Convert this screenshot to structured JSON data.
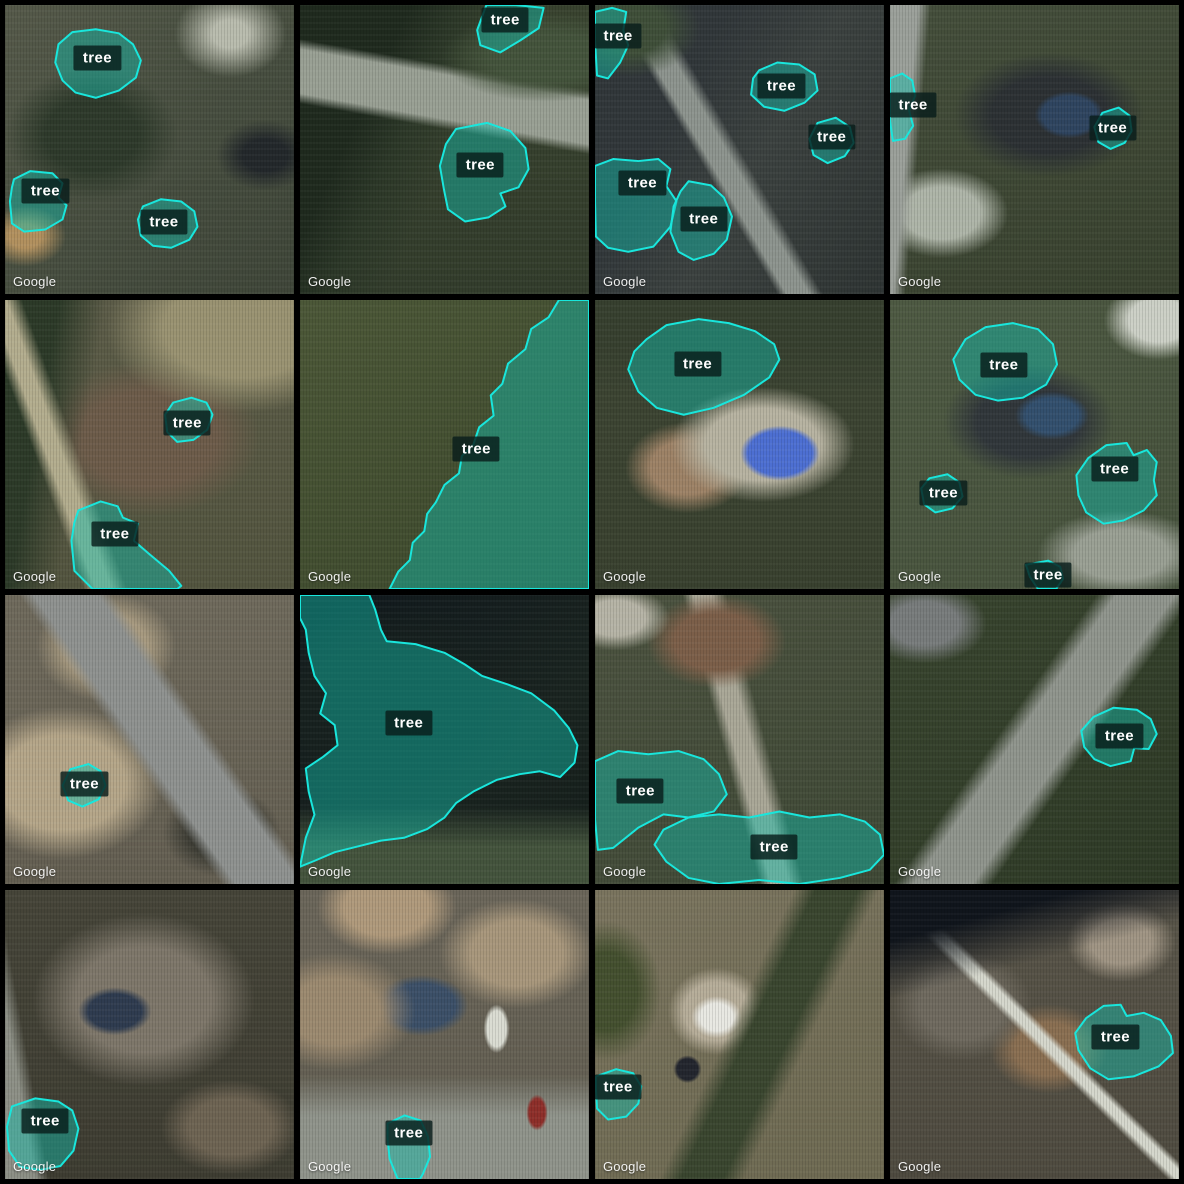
{
  "app": {
    "name": "satellite-tree-annotation-grid"
  },
  "watermark": "Google",
  "annotation_style": {
    "label": "tree",
    "stroke_color": "#19e6dc",
    "fill_color": "rgba(18,190,174,0.45)",
    "label_bg": "rgba(9,29,27,0.82)",
    "label_color": "#ffffff"
  },
  "grid": {
    "rows": 4,
    "cols": 4,
    "gap_px": 6,
    "border_color": "#000000"
  },
  "tiles": [
    {
      "id": "r1c1",
      "annotations": [
        {
          "label": "tree",
          "cx": 32,
          "cy": 18.5,
          "points": "18.5,13.6 23.3,9.4 31.4,8.4 39.4,9.8 44.3,13.6 47,19.2 45.3,25.1 39.4,29.6 31.4,32.1 24.4,30.3 19.9,26.1 17.4,19.9"
        },
        {
          "label": "tree",
          "cx": 14,
          "cy": 64.5,
          "points": "3.1,60.3 8.7,57.5 16.4,58.2 19.9,61.7 18.5,66.6 21.3,69.3 19.9,74.2 13.9,77.7 6.6,78.4 2.4,75.6 1.7,67.9 2.4,63.1"
        },
        {
          "label": "tree",
          "cx": 55,
          "cy": 75,
          "points": "47.7,69.7 54,67.2 61,68 65.5,71.4 66.6,76.7 63.8,81.2 57.5,84 51.2,83.3 47,79.8 46,74.2"
        }
      ]
    },
    {
      "id": "r1c2",
      "annotations": [
        {
          "label": "tree",
          "cx": 71,
          "cy": 5.2,
          "points": "64.5,0 74.6,0 84.3,1 82.6,8 76.3,12.2 69.3,16.4 62.4,13.9 61.3,8.7"
        },
        {
          "label": "tree",
          "cx": 62.4,
          "cy": 55.4,
          "points": "54,42.9 64.8,40.8 72.8,43.6 78,49.5 79.1,56.8 75.6,63.1 69.3,65.2 71.1,69.7 65.2,73.5 57.1,74.9 51.2,70.7 49.8,63.8 48.4,55.7 50.5,48.1"
        }
      ]
    },
    {
      "id": "r1c3",
      "annotations": [
        {
          "label": "tree",
          "cx": 8,
          "cy": 10.8,
          "points": "0,2.4 5.9,1 10.8,2.4 9.8,8.7 11.5,13.9 8.7,19.9 4.5,25.4 0.7,24.4 0,12.2"
        },
        {
          "label": "tree",
          "cx": 64.5,
          "cy": 27.9,
          "points": "56.8,22.6 63.1,19.9 70.7,20.6 76,24 77,29.6 72.5,33.8 65.5,36.6 58.5,35.2 54,31 54.7,25.4"
        },
        {
          "label": "tree",
          "cx": 81.9,
          "cy": 45.6,
          "points": "77,40.8 83.3,39 88.2,42.2 89.5,47.7 86.4,52.3 80.5,54.7 75.6,51.9 74.2,46.3"
        },
        {
          "label": "tree",
          "cx": 16.4,
          "cy": 61.7,
          "points": "0,55.7 6.3,53.3 15,54 21.9,53.3 26.1,56.8 24.7,62.7 28.2,67.9 26.1,76.7 20.2,83.6 11.5,85.4 4.5,84 0.3,80.1 0,67.9"
        },
        {
          "label": "tree",
          "cx": 37.6,
          "cy": 74.2,
          "points": "32.4,61 40.1,62.4 44.6,66.6 47.4,73.2 45.6,81.2 41.1,86.1 34.1,88.2 28.9,85.4 26.1,78.4 27.2,69.7 29.6,64.5"
        }
      ]
    },
    {
      "id": "r1c4",
      "annotations": [
        {
          "label": "tree",
          "cx": 8,
          "cy": 34.5,
          "points": "0,25.4 4.2,23.7 7.7,26.1 8.7,31.4 6.6,36.6 8,41.8 5.2,46.3 1,47 0,40.1"
        },
        {
          "label": "tree",
          "cx": 77,
          "cy": 42.5,
          "points": "73.5,37.3 79.1,35.5 82.9,38.3 83.6,43.6 81.2,47.7 76.3,49.8 72.1,47.4 70.7,42.2"
        }
      ]
    },
    {
      "id": "r2c1",
      "annotations": [
        {
          "label": "tree",
          "cx": 63.1,
          "cy": 42.5,
          "points": "58.2,35.5 64.5,33.8 69.7,35.5 71.8,39.7 70,44.9 65.2,48.4 59.6,49.1 56.1,45.6 55.4,39.7"
        },
        {
          "label": "tree",
          "cx": 38,
          "cy": 80.8,
          "points": "25.4,72.8 33.1,69.7 39,71.4 40.8,75.3 46,77.4 44.6,83.3 49.8,87.8 56.8,93.7 61,98.9 59.6,100 30.3,100 24,93.7 23,83.3 24,77"
        }
      ]
    },
    {
      "id": "r2c2",
      "annotations": [
        {
          "label": "tree",
          "cx": 61,
          "cy": 51.7,
          "points": "89.6,0 100,0 100,100 31,100 34,94 38,90 39,84 43,80 44,74 47,70 50,64 55,60 56,54 60,50 62,44 67,40 66,33 70,29 72,22 78,17 80,10 86,6"
        }
      ]
    },
    {
      "id": "r2c3",
      "annotations": [
        {
          "label": "tree",
          "cx": 35.5,
          "cy": 22,
          "points": "17.8,13.6 24.7,8.7 35.9,6.6 46.3,8 55.4,10.8 62,15.3 63.8,20.6 60.3,26.8 51.6,32.8 41.1,37.3 30.7,39.7 21.3,37.3 15,31.7 11.5,24 13.6,17.8"
        }
      ]
    },
    {
      "id": "r2c4",
      "annotations": [
        {
          "label": "tree",
          "cx": 39.4,
          "cy": 22.5,
          "points": "26.1,13.6 33.1,9.4 42.5,8 51.2,10.1 56.4,15.3 57.8,22.3 54,29.3 46,33.8 37.3,34.8 29.6,32.8 24,27.5 21.9,20.6"
        },
        {
          "label": "tree",
          "cx": 77.7,
          "cy": 58.5,
          "points": "68.6,54.7 74.9,50.2 81.9,49.5 84.3,53.7 88.9,51.9 92.3,56.1 91.3,62.4 92.3,67.6 87.8,72.8 80.8,76.3 73.9,77.4 67.9,73.5 65.2,67.6 64.5,60.6"
        },
        {
          "label": "tree",
          "cx": 18.5,
          "cy": 66.9,
          "points": "13.6,61.7 19.9,60.3 24,63.1 25.1,68 21.6,72.1 15.7,73.5 11.8,70.7 10.8,65.2"
        },
        {
          "label": "tree",
          "cx": 54.7,
          "cy": 95.1,
          "points": "47,91.6 54.7,90.2 58.9,92.3 59.9,96.5 57.5,100 51.2,100 48.4,95.8"
        }
      ]
    },
    {
      "id": "r3c1",
      "annotations": [
        {
          "label": "tree",
          "cx": 27.5,
          "cy": 65.5,
          "points": "22.6,60.3 28.9,58.5 33.1,61 34.8,65.9 32.4,70.7 26.8,73.2 21.9,71.1 19.9,65.9"
        }
      ]
    },
    {
      "id": "r3c2",
      "annotations": [
        {
          "label": "tree",
          "cx": 37.6,
          "cy": 44.3,
          "points": "0,0 24,0 26,5 28,12 30,16 40,17 50,20 57,24 63,28 72,31 80,34 88,40 93,46 96,52 95,58 90,63 83,61 76,62 68,64 60,68 54,72 50,77 44,81 36,84 28,85 20,87 12,89 5,92 0,94 2,84 5,76 3,68 2,60 8,56 13,52 12,45 7,41 9,34 5,28 3,20 2,12 0,8"
        }
      ]
    },
    {
      "id": "r3c3",
      "annotations": [
        {
          "label": "tree",
          "cx": 15.7,
          "cy": 67.9,
          "points": "0,57.5 8,54 18.5,55.1 28.9,54 37.6,56.8 42.9,62 45.6,69 41.1,74.9 32.4,77 23.7,75.9 15,80.5 6.3,87.5 1,88.2 0,77.7"
        },
        {
          "label": "tree",
          "cx": 62,
          "cy": 87.1,
          "points": "23.7,81.2 32.4,77 42.9,75.9 53.3,77 63.8,74.9 74.2,77 84.7,75.9 93.4,78.4 98.6,82.9 100,89.9 95.1,95.1 84.7,97.9 70.7,100 56.8,98.6 42.9,100 32.4,97.9 24.7,92.3 20.6,86.4"
        }
      ]
    },
    {
      "id": "r3c4",
      "annotations": [
        {
          "label": "tree",
          "cx": 79.4,
          "cy": 48.8,
          "points": "70.4,42.2 77.4,39 85.4,39.7 90.2,42.9 92.3,48.1 89.5,53.3 84.5,53 83.3,57.5 76.3,59.2 70.7,56.8 67.2,52.6 66.2,47"
        }
      ]
    },
    {
      "id": "r4c1",
      "annotations": [
        {
          "label": "tree",
          "cx": 13.9,
          "cy": 80.1,
          "points": "2.4,74.9 10.5,72.1 18.5,73.2 23.3,76.3 25.4,82.6 23.7,90.2 19.2,95.5 12.2,96.9 5.2,95.8 1.4,90.2 0.7,81.9"
        }
      ]
    },
    {
      "id": "r4c2",
      "annotations": [
        {
          "label": "tree",
          "cx": 37.6,
          "cy": 84,
          "points": "30.3,80.8 36.2,78 41.8,79.8 44.3,85.4 45,92.3 42.5,98.3 41.5,100 33.8,100 31,93 30.3,86.1"
        }
      ]
    },
    {
      "id": "r4c3",
      "annotations": [
        {
          "label": "tree",
          "cx": 8,
          "cy": 68.3,
          "points": "0.3,64.5 7.3,62 13.2,63.4 16,67.9 15,73.9 10.8,78.4 4.5,79.4 0.7,75.6 0.3,68.6"
        }
      ]
    },
    {
      "id": "r4c4",
      "annotations": [
        {
          "label": "tree",
          "cx": 78,
          "cy": 50.9,
          "points": "67.9,44.3 73.9,40.1 79.8,39.7 81.9,43.6 87.8,42.5 93.7,45 97.2,50.5 97.9,56.4 93,61 84.3,64.5 75.6,65.5 69.3,61.7 65.2,55.4 64.1,49.5"
        }
      ]
    }
  ]
}
